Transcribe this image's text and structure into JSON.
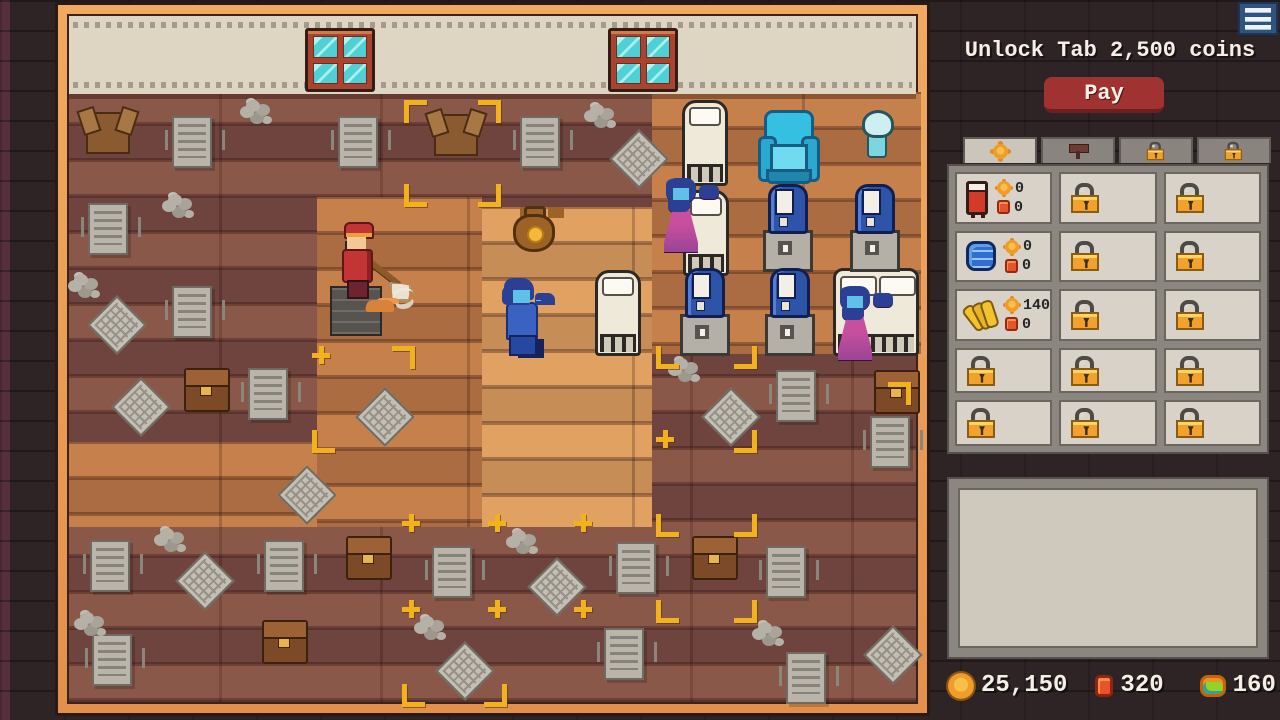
{
  "header": {
    "unlock_text": "Unlock Tab 2,500 coins",
    "pay_label": "Pay",
    "menu_icon": "hamburger-menu-icon"
  },
  "shop": {
    "tabs": [
      {
        "name": "tab-items",
        "icon": "coin-icon",
        "active": true
      },
      {
        "name": "tab-tools",
        "icon": "hammer-icon",
        "active": false
      },
      {
        "name": "tab-locked-1",
        "icon": "lock-icon",
        "active": false
      },
      {
        "name": "tab-locked-2",
        "icon": "lock-icon",
        "active": false
      }
    ],
    "slots": [
      {
        "state": "item",
        "icon": "red-bed-icon",
        "coin_cost": "0",
        "gem_cost": "0"
      },
      {
        "state": "locked"
      },
      {
        "state": "locked"
      },
      {
        "state": "item",
        "icon": "blue-towels-icon",
        "coin_cost": "0",
        "gem_cost": "0"
      },
      {
        "state": "locked"
      },
      {
        "state": "locked"
      },
      {
        "state": "item",
        "icon": "bananas-icon",
        "coin_cost": "140",
        "gem_cost": "0"
      },
      {
        "state": "locked"
      },
      {
        "state": "locked"
      },
      {
        "state": "locked"
      },
      {
        "state": "locked"
      },
      {
        "state": "locked"
      },
      {
        "state": "locked"
      },
      {
        "state": "locked"
      },
      {
        "state": "locked"
      }
    ],
    "detail_panel_text": ""
  },
  "currencies": [
    {
      "name": "coins",
      "icon": "gold-coin-icon",
      "value": "25,150"
    },
    {
      "name": "red-gems",
      "icon": "red-gem-icon",
      "value": "320"
    },
    {
      "name": "green-gems",
      "icon": "green-gem-icon",
      "value": "160"
    }
  ],
  "game": {
    "sprites": [
      {
        "t": "window",
        "x": 305,
        "y": 28
      },
      {
        "t": "window",
        "x": 608,
        "y": 28
      },
      {
        "t": "crate",
        "x": 86,
        "y": 112
      },
      {
        "t": "crate",
        "x": 434,
        "y": 114
      },
      {
        "t": "paper",
        "x": 172,
        "y": 116
      },
      {
        "t": "paper",
        "x": 338,
        "y": 116
      },
      {
        "t": "paper",
        "x": 520,
        "y": 116
      },
      {
        "t": "paper",
        "x": 88,
        "y": 203
      },
      {
        "t": "paper",
        "x": 172,
        "y": 286
      },
      {
        "t": "paper",
        "x": 248,
        "y": 368
      },
      {
        "t": "paper",
        "x": 776,
        "y": 370
      },
      {
        "t": "paper",
        "x": 870,
        "y": 416
      },
      {
        "t": "paper",
        "x": 90,
        "y": 540
      },
      {
        "t": "paper",
        "x": 264,
        "y": 540
      },
      {
        "t": "paper",
        "x": 432,
        "y": 546
      },
      {
        "t": "paper",
        "x": 616,
        "y": 542
      },
      {
        "t": "paper",
        "x": 766,
        "y": 546
      },
      {
        "t": "paper",
        "x": 604,
        "y": 628
      },
      {
        "t": "paper",
        "x": 786,
        "y": 652
      },
      {
        "t": "paper",
        "x": 92,
        "y": 634
      },
      {
        "t": "dust",
        "x": 246,
        "y": 100
      },
      {
        "t": "dust",
        "x": 590,
        "y": 104
      },
      {
        "t": "dust",
        "x": 168,
        "y": 194
      },
      {
        "t": "dust",
        "x": 74,
        "y": 274
      },
      {
        "t": "dust",
        "x": 674,
        "y": 358
      },
      {
        "t": "dust",
        "x": 160,
        "y": 528
      },
      {
        "t": "dust",
        "x": 512,
        "y": 530
      },
      {
        "t": "dust",
        "x": 420,
        "y": 616
      },
      {
        "t": "dust",
        "x": 758,
        "y": 622
      },
      {
        "t": "dust",
        "x": 80,
        "y": 612
      },
      {
        "t": "diamond",
        "x": 618,
        "y": 138
      },
      {
        "t": "diamond",
        "x": 96,
        "y": 304
      },
      {
        "t": "diamond",
        "x": 364,
        "y": 396
      },
      {
        "t": "diamond",
        "x": 710,
        "y": 396
      },
      {
        "t": "diamond",
        "x": 120,
        "y": 386
      },
      {
        "t": "diamond",
        "x": 184,
        "y": 560
      },
      {
        "t": "diamond",
        "x": 536,
        "y": 566
      },
      {
        "t": "diamond",
        "x": 444,
        "y": 650
      },
      {
        "t": "diamond",
        "x": 872,
        "y": 634
      },
      {
        "t": "diamond",
        "x": 286,
        "y": 474
      },
      {
        "t": "chest",
        "x": 184,
        "y": 368
      },
      {
        "t": "chest",
        "x": 874,
        "y": 370
      },
      {
        "t": "chest",
        "x": 346,
        "y": 536
      },
      {
        "t": "chest",
        "x": 692,
        "y": 536
      },
      {
        "t": "chest",
        "x": 262,
        "y": 620
      },
      {
        "t": "mk_tl",
        "x": 404,
        "y": 100
      },
      {
        "t": "mk_tr",
        "x": 478,
        "y": 100
      },
      {
        "t": "mk_bl",
        "x": 404,
        "y": 184
      },
      {
        "t": "mk_br",
        "x": 478,
        "y": 184
      },
      {
        "t": "mk_plus",
        "x": 312,
        "y": 346
      },
      {
        "t": "mk_tr",
        "x": 392,
        "y": 346
      },
      {
        "t": "mk_bl",
        "x": 656,
        "y": 346
      },
      {
        "t": "mk_br",
        "x": 734,
        "y": 346
      },
      {
        "t": "mk_bl",
        "x": 312,
        "y": 430
      },
      {
        "t": "mk_plus",
        "x": 656,
        "y": 430
      },
      {
        "t": "mk_br",
        "x": 734,
        "y": 430
      },
      {
        "t": "mk_plus",
        "x": 402,
        "y": 514
      },
      {
        "t": "mk_plus",
        "x": 488,
        "y": 514
      },
      {
        "t": "mk_plus",
        "x": 574,
        "y": 514
      },
      {
        "t": "mk_bl",
        "x": 656,
        "y": 514
      },
      {
        "t": "mk_br",
        "x": 734,
        "y": 514
      },
      {
        "t": "mk_plus",
        "x": 402,
        "y": 600
      },
      {
        "t": "mk_plus",
        "x": 488,
        "y": 600
      },
      {
        "t": "mk_plus",
        "x": 574,
        "y": 600
      },
      {
        "t": "mk_bl",
        "x": 656,
        "y": 600
      },
      {
        "t": "mk_br",
        "x": 734,
        "y": 600
      },
      {
        "t": "mk_bl",
        "x": 402,
        "y": 684
      },
      {
        "t": "mk_br",
        "x": 484,
        "y": 684
      },
      {
        "t": "mk_tr",
        "x": 888,
        "y": 382
      },
      {
        "t": "bed-v",
        "x": 682,
        "y": 100
      },
      {
        "t": "bed-v",
        "x": 683,
        "y": 190
      },
      {
        "t": "bed-v",
        "x": 595,
        "y": 270
      },
      {
        "t": "bed-h",
        "x": 833,
        "y": 268
      },
      {
        "t": "chair",
        "x": 758,
        "y": 110
      },
      {
        "t": "gchair",
        "x": 845,
        "y": 108
      },
      {
        "t": "machine",
        "x": 763,
        "y": 184
      },
      {
        "t": "machine",
        "x": 850,
        "y": 184
      },
      {
        "t": "machine",
        "x": 680,
        "y": 268
      },
      {
        "t": "machine",
        "x": 765,
        "y": 268
      },
      {
        "t": "gwoman",
        "x": 664,
        "y": 178
      },
      {
        "t": "gwoman",
        "x": 838,
        "y": 286
      },
      {
        "t": "gman",
        "x": 500,
        "y": 278
      },
      {
        "t": "moneybag",
        "x": 513,
        "y": 206
      },
      {
        "t": "bellhop",
        "x": 330,
        "y": 222
      }
    ]
  }
}
